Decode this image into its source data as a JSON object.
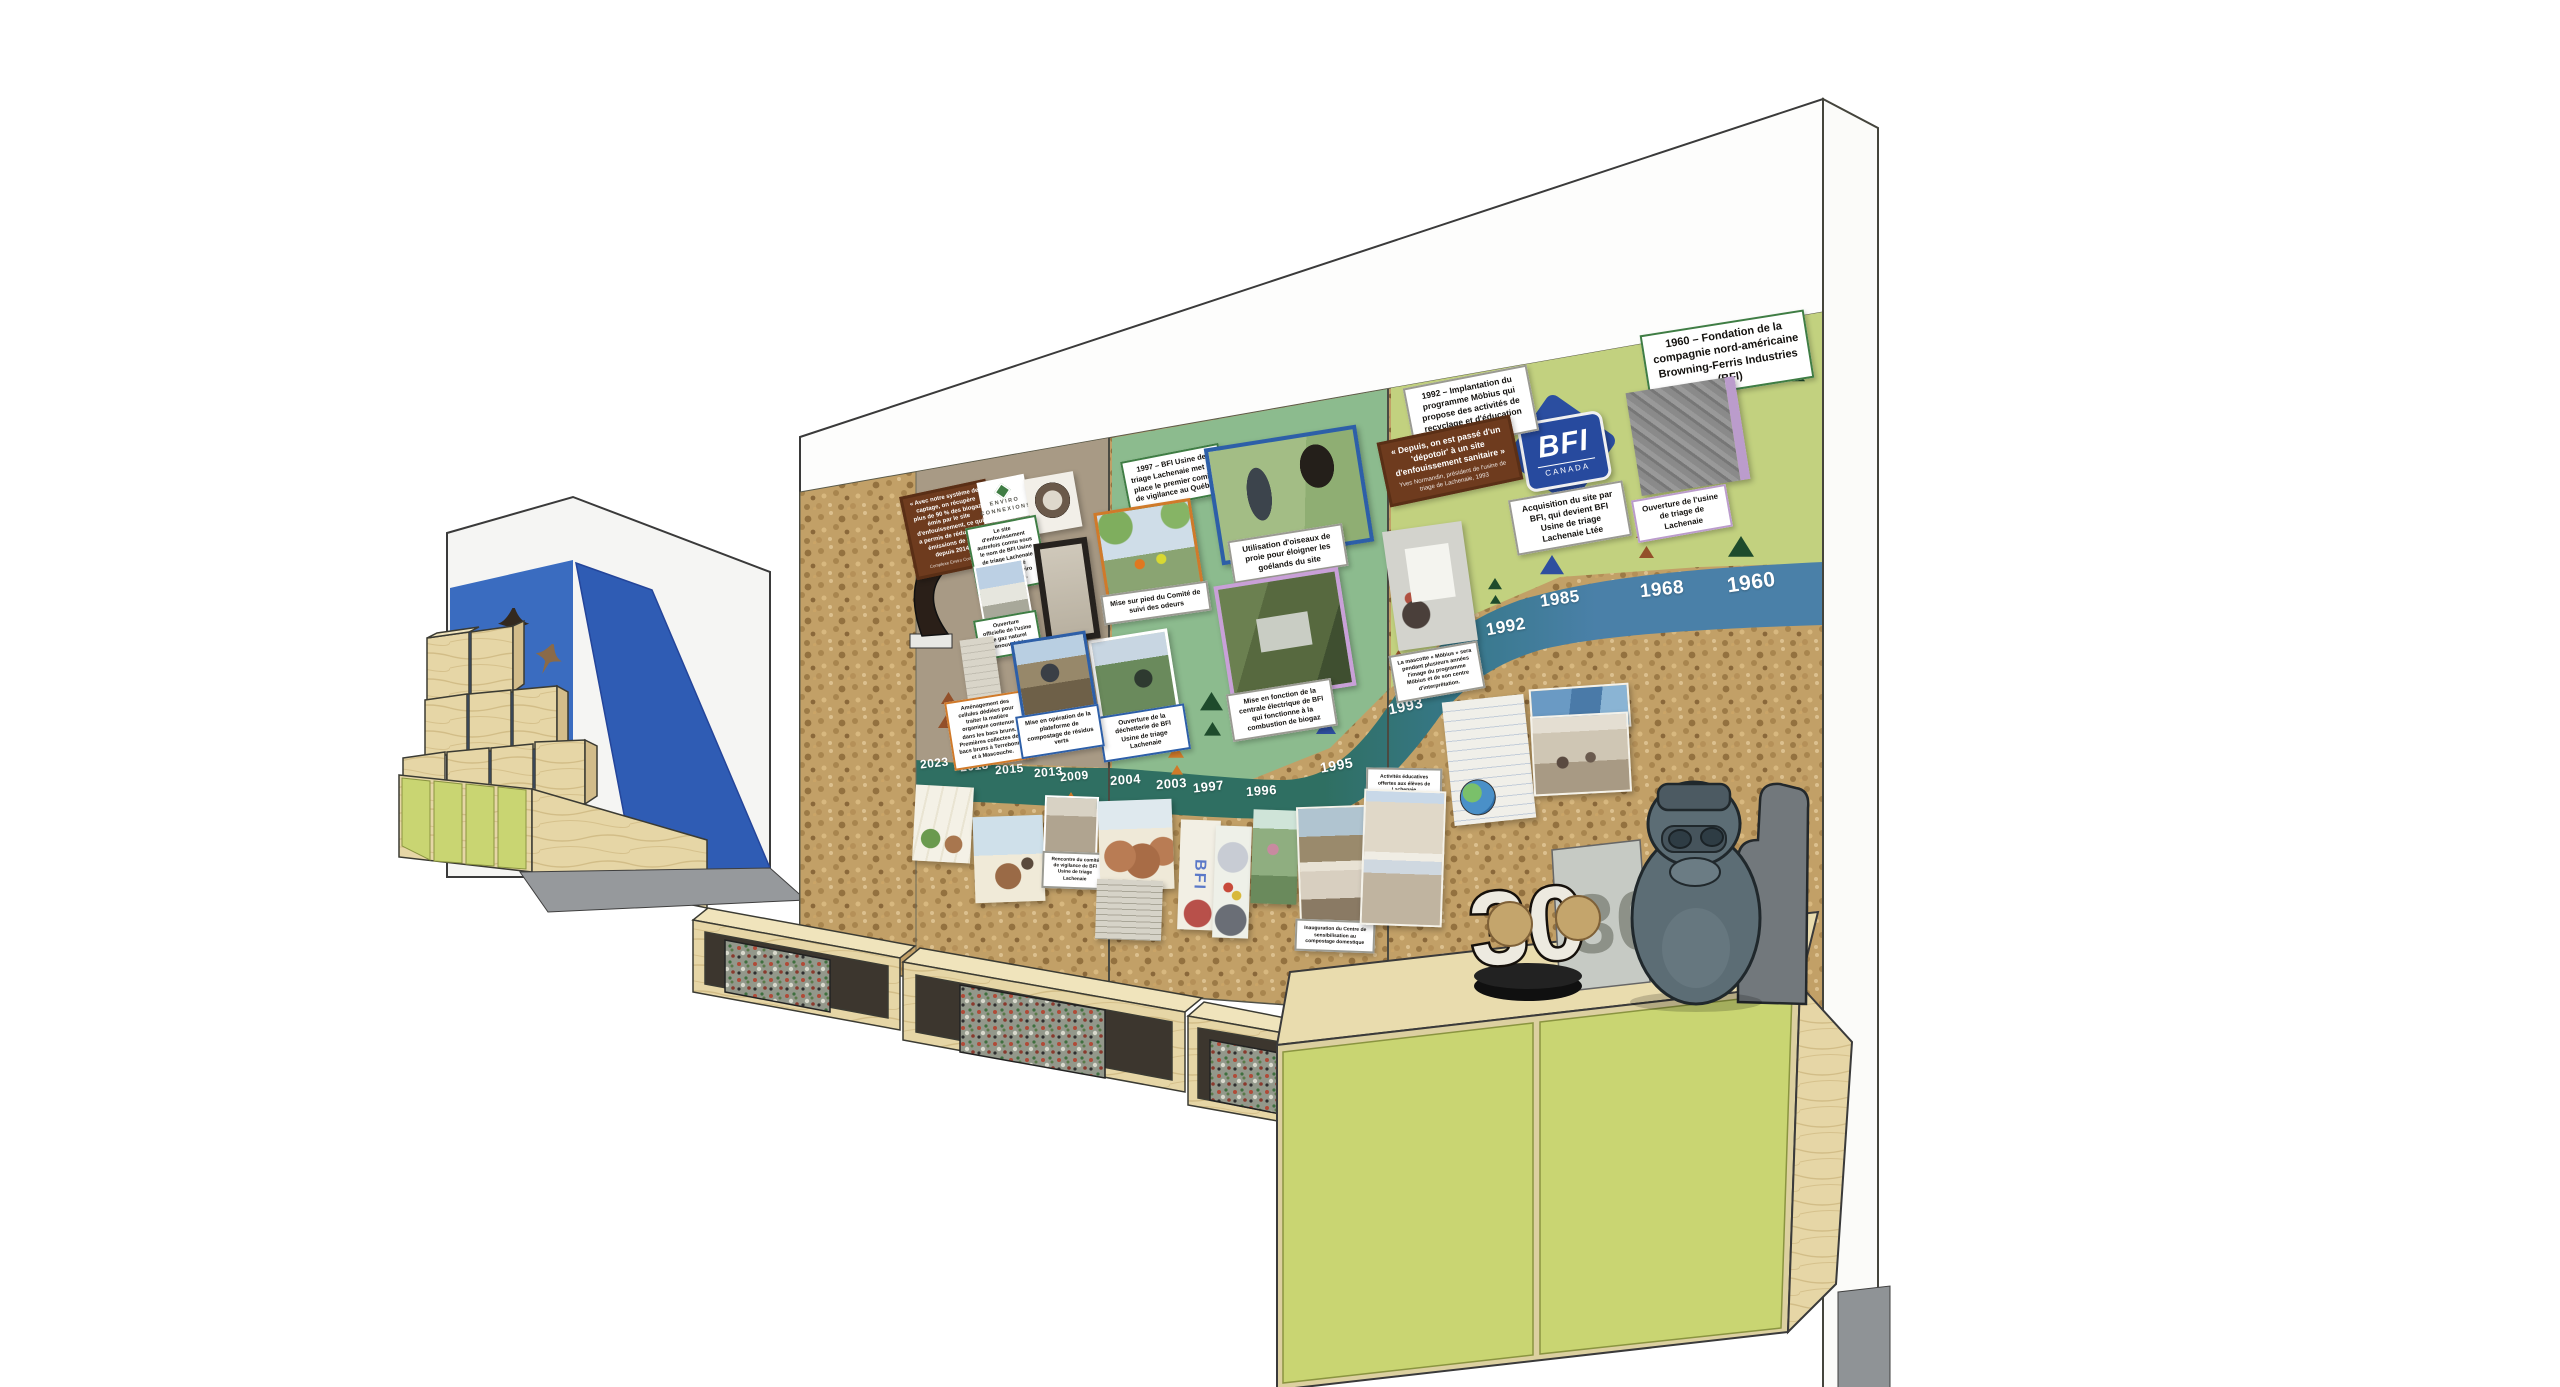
{
  "palette": {
    "cork": "#c2a067",
    "brown_panel": "#a89a85",
    "sage_panel": "#8cbb8e",
    "light_green_panel": "#c2d17f",
    "river_teal": "#2f6f62",
    "river_blue": "#4a80a8",
    "chartreuse": "#c9d572",
    "plywood": "#e6d6a6",
    "bfi_blue": "#2b4ea0"
  },
  "timeline": {
    "years": [
      "2023",
      "2018",
      "2015",
      "2013",
      "2009",
      "2004",
      "2003",
      "1997",
      "1996",
      "1995",
      "1993",
      "1992",
      "1985",
      "1968",
      "1960"
    ]
  },
  "panels": {
    "founding_1960": "1960 – Fondation de la compagnie nord-américaine Browning-Ferris Industries (BFI)",
    "plant_opening": "Ouverture de l'usine de triage de Lachenaie",
    "acquisition": "Acquisition du site par BFI, qui devient BFI Usine de triage Lachenaie Ltée",
    "mobius_1992": "1992 – Implantation du programme Möbius qui propose des activités de recyclage et d'éducation environnementale",
    "quote_depotoir": "« Depuis, on est passé d'un 'dépotoir' à un site d'enfouissement sanitaire »",
    "quote_depotoir_attr": "Yves Normandin, président de l'usine de triage de Lachenaie, 1993",
    "mascot": "La mascotte « Möbius » sera pendant plusieurs années l'image du programme Möbius et de son centre d'interprétation.",
    "vigilance_1997": "1997 – BFI Usine de triage Lachenaie met en place le premier comité de vigilance au Québec",
    "birds_of_prey": "Utilisation d'oiseaux de proie pour éloigner les goélands du site",
    "odour_committee": "Mise sur pied du Comité de suivi des odeurs",
    "power_station": "Mise en fonction de la centrale électrique de BFI qui fonctionne à la combustion de biogaz",
    "drop_off": "Ouverture de la déchetterie de BFI Usine de triage Lachenaie",
    "composting": "Mise en opération de la plateforme de compostage de résidus verts",
    "brown_bins": "Aménagement des cellules dédiées pour traiter la matière organique contenue dans les bacs bruns. Premières collectes des bacs bruns à Terrebonne et à Mascouche.",
    "renamed": "Le site d'enfouissement autrefois connu sous le nom de BFI Usine de triage Lachenaie est renommé Complexe Enviro Connexions.",
    "rng_plant": "Ouverture officielle de l'usine de gaz naturel renouvelable",
    "quote_capture": "« Avec notre système de captage, on récupère plus de 90 % des biogaz émis par le site d'enfouissement, ce qui a permis de réduire nos émissions de GES depuis 2014. »",
    "quote_capture_attr": "Complexe Enviro Connexions",
    "vigilance_meeting": "Rencontre du comité de vigilance de BFI Usine de triage Lachenaie",
    "compost_centre": "Inauguration du Centre de sensibilisation au compostage domestique",
    "school_activities": "Activités éducatives offertes aux élèves de Lachenaie"
  },
  "logos": {
    "bfi_name": "BFI",
    "bfi_country": "CANADA",
    "enviro_line1": "Enviro",
    "enviro_line2": "Connexions"
  },
  "objects": {
    "anniversary_trophy": "30",
    "child_drawing_letters": "BFI"
  }
}
